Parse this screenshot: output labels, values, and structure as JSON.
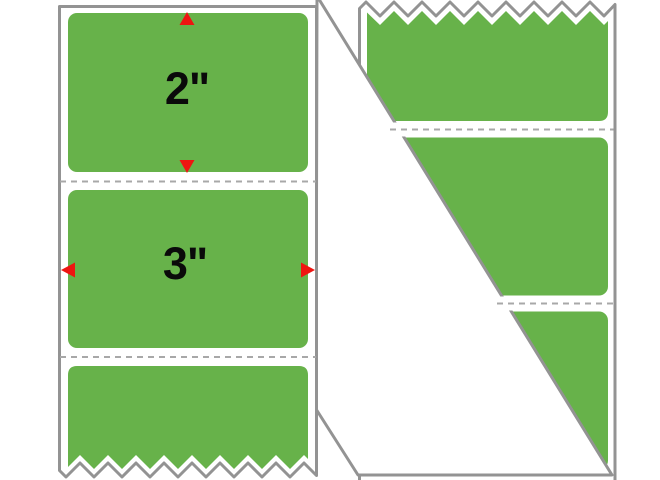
{
  "image": {
    "background": "#FFFFFF",
    "subject": "fanfold strip of blank green rectangular labels on a liner, front strip with dimension markers and back strip with torn zigzag edge and folded-over white liner corner"
  },
  "colors": {
    "label_green": "#67B24A",
    "liner_white": "#FFFFFF",
    "edge_gray": "#939393",
    "perforation_gray": "#A8A8A8",
    "arrow_red": "#EE1511",
    "dimension_text": "#0A0A0A"
  },
  "front_strip": {
    "height_dimension_label": "2\"",
    "width_dimension_label": "3\"",
    "labels_visible": 3,
    "perforations_visible": 2,
    "torn_edge": "bottom"
  },
  "back_strip": {
    "labels_visible": 3,
    "perforations_visible": 2,
    "torn_edge": "top",
    "fold": "white liner triangle folded across lower-left"
  }
}
